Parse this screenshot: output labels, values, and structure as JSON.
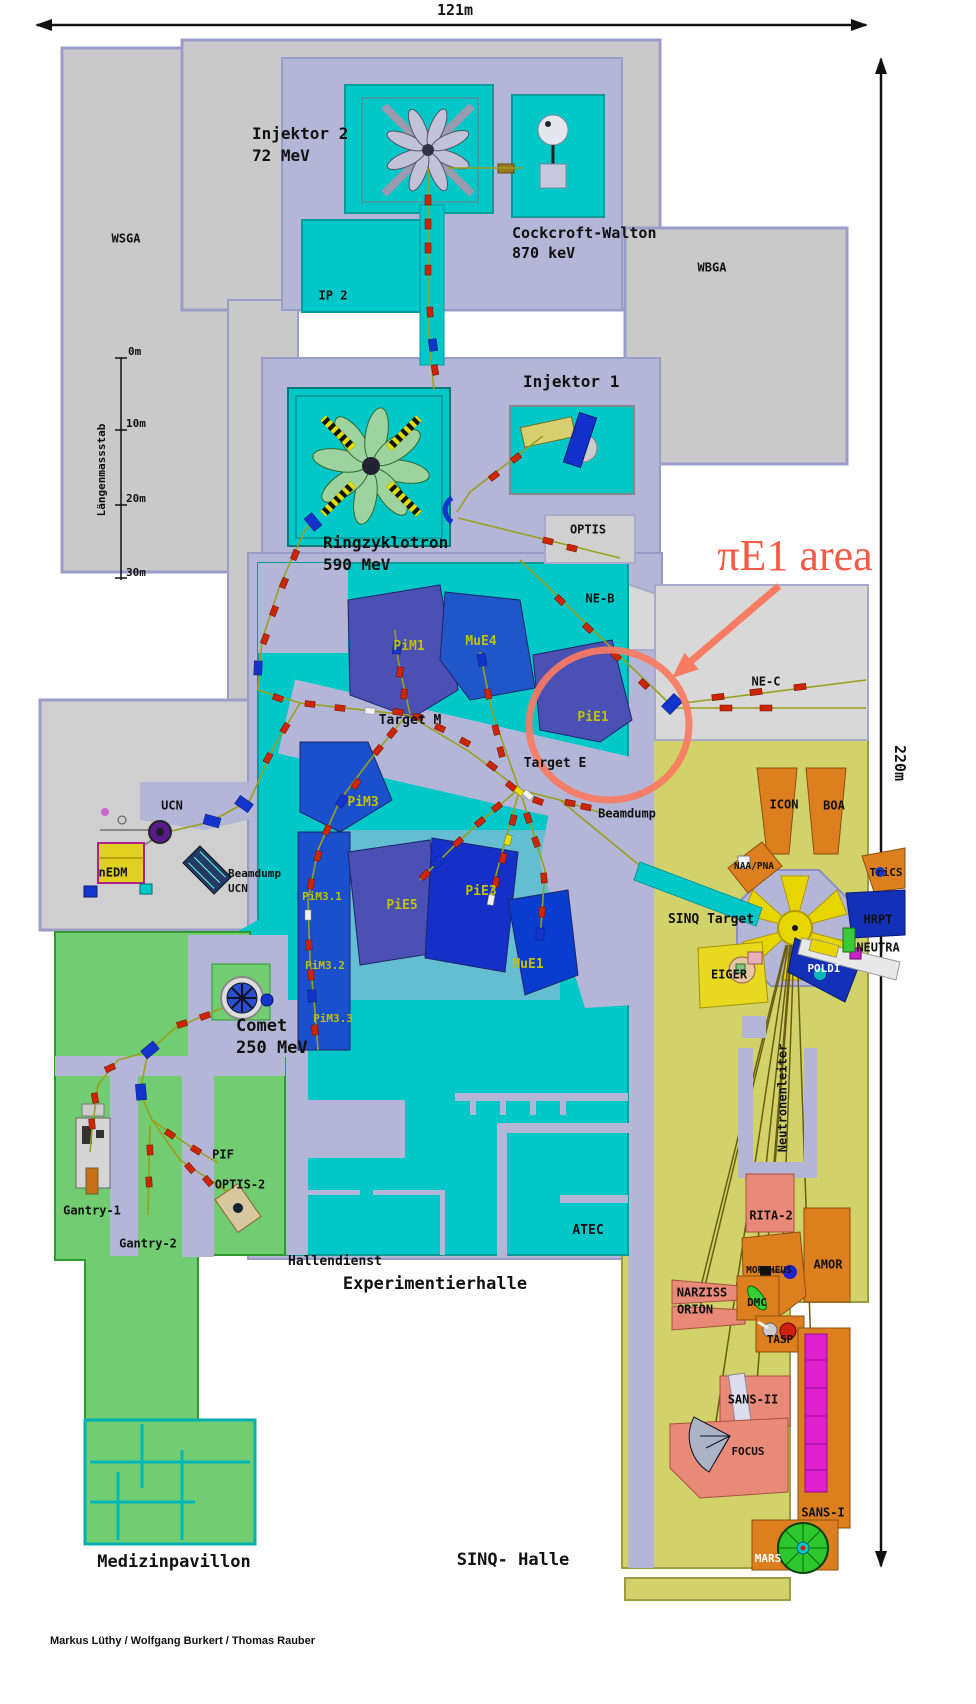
{
  "scale_annotations": {
    "width": "121m",
    "height": "220m"
  },
  "ruler": {
    "title": "Längenmassstab",
    "t0": "0m",
    "t10": "10m",
    "t20": "20m",
    "t30": "30m"
  },
  "highlight": {
    "pie1_area": "πE1 area",
    "color": "#f55a46"
  },
  "credits": "Markus Lüthy / Wolfgang Burkert / Thomas Rauber",
  "halls": {
    "experimentierhalle": "Experimentierhalle",
    "sinq_halle": "SINQ- Halle",
    "medizinpavillon": "Medizinpavillon",
    "hallendienst": "Hallendienst",
    "atec": "ATEC",
    "wsga": "WSGA",
    "wbga": "WBGA",
    "neutronenleiter": "Neutronenleiter"
  },
  "accelerators": {
    "injektor2": "Injektor 2",
    "injektor2_energy": "72 MeV",
    "cockcroft": "Cockcroft-Walton",
    "cockcroft_energy": "870 keV",
    "injektor1": "Injektor 1",
    "ip2": "IP 2",
    "ringzyklotron": "Ringzyklotron",
    "ringzyklotron_energy": "590 MeV",
    "comet": "Comet",
    "comet_energy": "250 MeV"
  },
  "targets": {
    "target_m": "Target M",
    "target_e": "Target E",
    "sinq_target": "SINQ Target",
    "beamdump": "Beamdump",
    "beamdump_ucn_line1": "Beamdump",
    "beamdump_ucn_line2": "UCN"
  },
  "beam_areas": {
    "pim1": "PiM1",
    "mue4": "MuE4",
    "pie1": "PiE1",
    "pim3": "PiM3",
    "pim3_1": "PiM3.1",
    "pim3_2": "PiM3.2",
    "pim3_3": "PiM3.3",
    "pie5": "PiE5",
    "pie3": "PiE3",
    "mue1": "MuE1",
    "ne_b": "NE-B",
    "ne_c": "NE-C",
    "optis": "OPTIS",
    "ucn": "UCN",
    "nedm": "nEDM"
  },
  "sinq_instruments": {
    "icon": "ICON",
    "boa": "BOA",
    "naa_pna": "NAA/PNA",
    "trics": "TriCS",
    "hrpt": "HRPT",
    "neutra": "NEUTRA",
    "poldi": "POLDI",
    "eiger": "EIGER",
    "rita2": "RITA-2",
    "amor": "AMOR",
    "morpheus": "MORPHEUS",
    "narziss": "NARZISS",
    "orion": "ORION",
    "dmc": "DMC",
    "tasp": "TASP",
    "sans2": "SANS-II",
    "focus": "FOCUS",
    "sans1": "SANS-I",
    "mars": "MARS"
  },
  "medical": {
    "pif": "PIF",
    "optis2": "OPTIS-2",
    "gantry1": "Gantry-1",
    "gantry2": "Gantry-2"
  },
  "colors": {
    "hall_cyan": "#00c8c8",
    "shield_lavender": "#b4b6d8",
    "building_gray": "#c9c9c9",
    "sinq_khaki": "#d2d26a",
    "medical_green": "#72cc72",
    "instrument_orange": "#dd7f1e",
    "instrument_salmon": "#e98a78",
    "beamline_olive": "#9aa01a",
    "magnet_red": "#cc2600",
    "magnet_blue": "#1334cc",
    "highlight_salmon": "#f97b62"
  }
}
